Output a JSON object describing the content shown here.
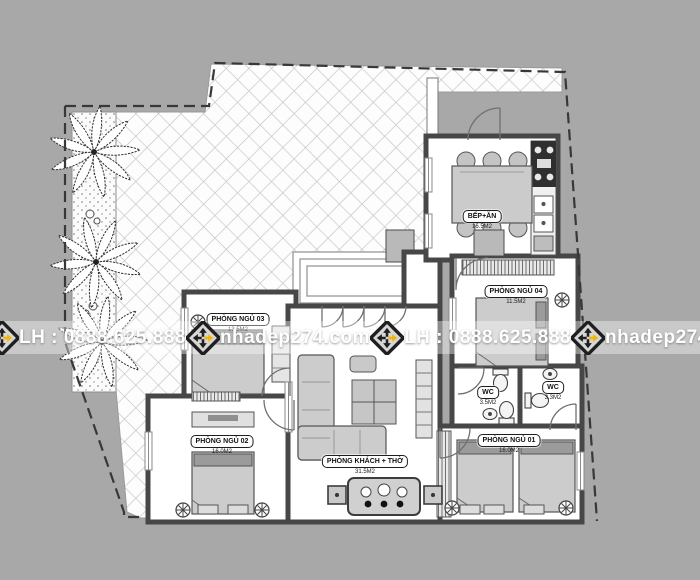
{
  "page": {
    "background_color": "#a8a8a8",
    "type_note": "single-storey house floor plan drawing"
  },
  "plan": {
    "rooms": [
      {
        "id": "bedroom-03",
        "label": "PHÒNG NGỦ 03",
        "area": "13.5M2"
      },
      {
        "id": "bedroom-02",
        "label": "PHÒNG NGỦ 02",
        "area": "16.0M2"
      },
      {
        "id": "living-worship",
        "label": "PHÒNG KHÁCH + THỜ",
        "area": "31.5M2"
      },
      {
        "id": "kitchen-dining",
        "label": "BẾP+ĂN",
        "area": "16.5M2"
      },
      {
        "id": "bedroom-04",
        "label": "PHÒNG NGỦ 04",
        "area": "11.5M2"
      },
      {
        "id": "wc-left",
        "label": "WC",
        "area": "3.5M2"
      },
      {
        "id": "wc-right",
        "label": "WC",
        "area": "3.3M2"
      },
      {
        "id": "bedroom-01",
        "label": "PHÒNG NGỦ 01",
        "area": "16.0M2"
      }
    ],
    "site": {
      "boundary_style": "dashed",
      "yard_finish": "diagonal paving tiles",
      "planting": "palm trees along left strip"
    },
    "colors": {
      "wall": "#474747",
      "tile_line": "#c2c2c2",
      "furniture_fill": "#cbcbcb",
      "boundary": "#383838"
    }
  },
  "watermark": {
    "phone_label": "LH : 0888.625.888",
    "website": "nhadep274.com",
    "band_color": "rgba(255,255,255,0.38)",
    "text_color": "#ffffff",
    "logo": {
      "name": "nhadep274-logo",
      "yellow": "#f2b705",
      "black": "#1f1f1f"
    }
  },
  "icons": {
    "palm-tree-icon": "top-view palm plant",
    "ceiling-fan-icon": "circle with cross petals",
    "toilet-icon": "bowl with tank",
    "sink-icon": "oval basin",
    "stove-icon": "4-burner cooktop",
    "nhadep274-logo-icon": "black diamond with pinwheel arrows, one yellow arrow"
  }
}
